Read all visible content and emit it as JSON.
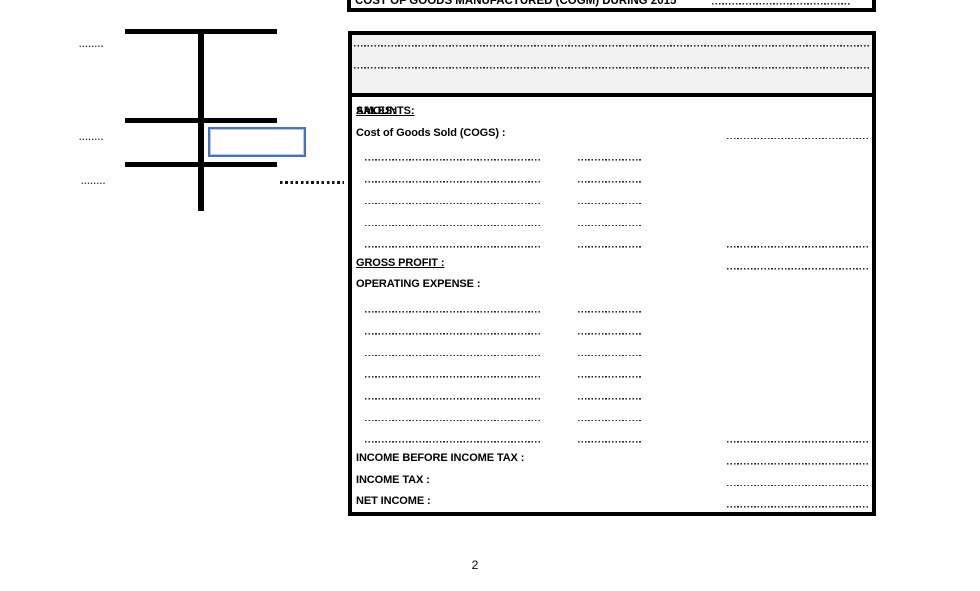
{
  "top_box": {
    "title": "COST OF GOODS MANUFACTURED (COGM) DURING 2015"
  },
  "statement": {
    "left_header": "SALES:",
    "right_header": "AMOUNTS:",
    "cogs_label": "Cost of Goods Sold (COGS) :",
    "gross_profit_label": "GROSS PROFIT :",
    "operating_expense_label": "OPERATING EXPENSE :",
    "income_before_tax_label": "INCOME BEFORE INCOME TAX :",
    "income_tax_label": "INCOME TAX :",
    "net_income_label": "NET INCOME :"
  },
  "t_account": {
    "placeholder_dots_1": "........",
    "placeholder_dots_2": "........",
    "placeholder_dots_3": "........"
  },
  "colors": {
    "shape_border_blue": "#4472C4",
    "header_band_gray": "#F2F2F2"
  },
  "page_number": "2"
}
